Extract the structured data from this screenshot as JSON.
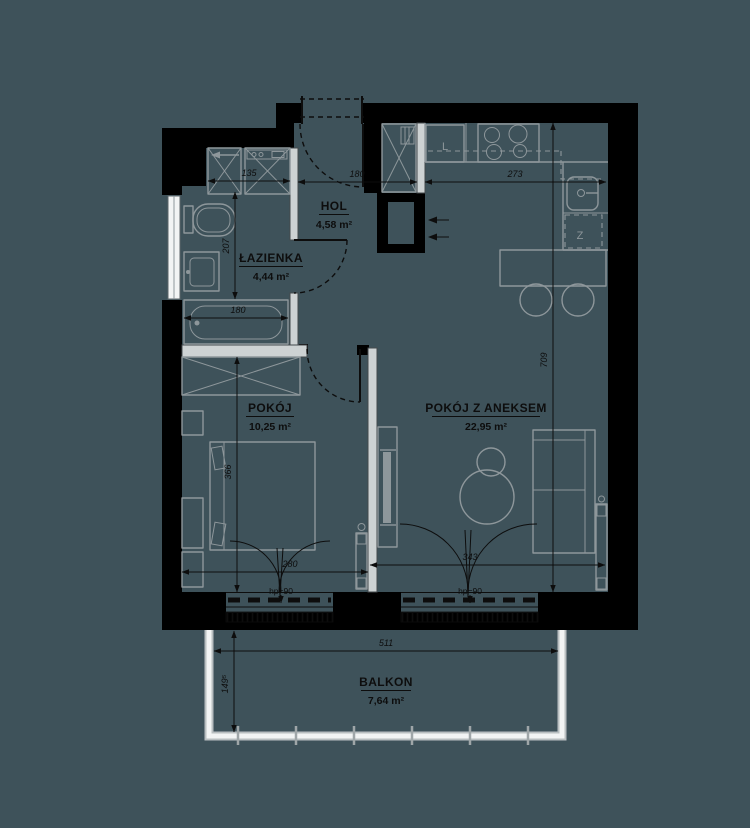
{
  "colors": {
    "background": "#3E525A",
    "wall": "#000000",
    "partition_fill": "#CDD2D3",
    "partition_edge": "#44494C",
    "furniture": "#8E979B",
    "light": "#F2F4F4",
    "rail": "#B9BFC1",
    "text": "#0D0D0D"
  },
  "rooms": [
    {
      "id": "lazienka",
      "name": "ŁAZIENKA",
      "area": "4,44 m²"
    },
    {
      "id": "hol",
      "name": "HOL",
      "area": "4,58 m²"
    },
    {
      "id": "pokoj",
      "name": "POKÓJ",
      "area": "10,25 m²"
    },
    {
      "id": "pokoj-z-aneksem",
      "name": "POKÓJ Z ANEKSEM",
      "area": "22,95 m²"
    },
    {
      "id": "balkon",
      "name": "BALKON",
      "area": "7,64 m²"
    }
  ],
  "dimensions": {
    "niche_width": "135",
    "bathroom_depth": "207",
    "bathtub_width": "180",
    "hol_width": "180",
    "kitchen_width": "273",
    "living_depth": "709",
    "bedroom_depth": "366",
    "bedroom_width": "280",
    "living_width": "343",
    "balcony_width": "511",
    "balcony_depth": "149⁵",
    "bedroom_window_sill": "hp=90",
    "living_window_sill": "hp=90"
  },
  "labels": {
    "fridge": "L",
    "dishwasher": "Z"
  }
}
